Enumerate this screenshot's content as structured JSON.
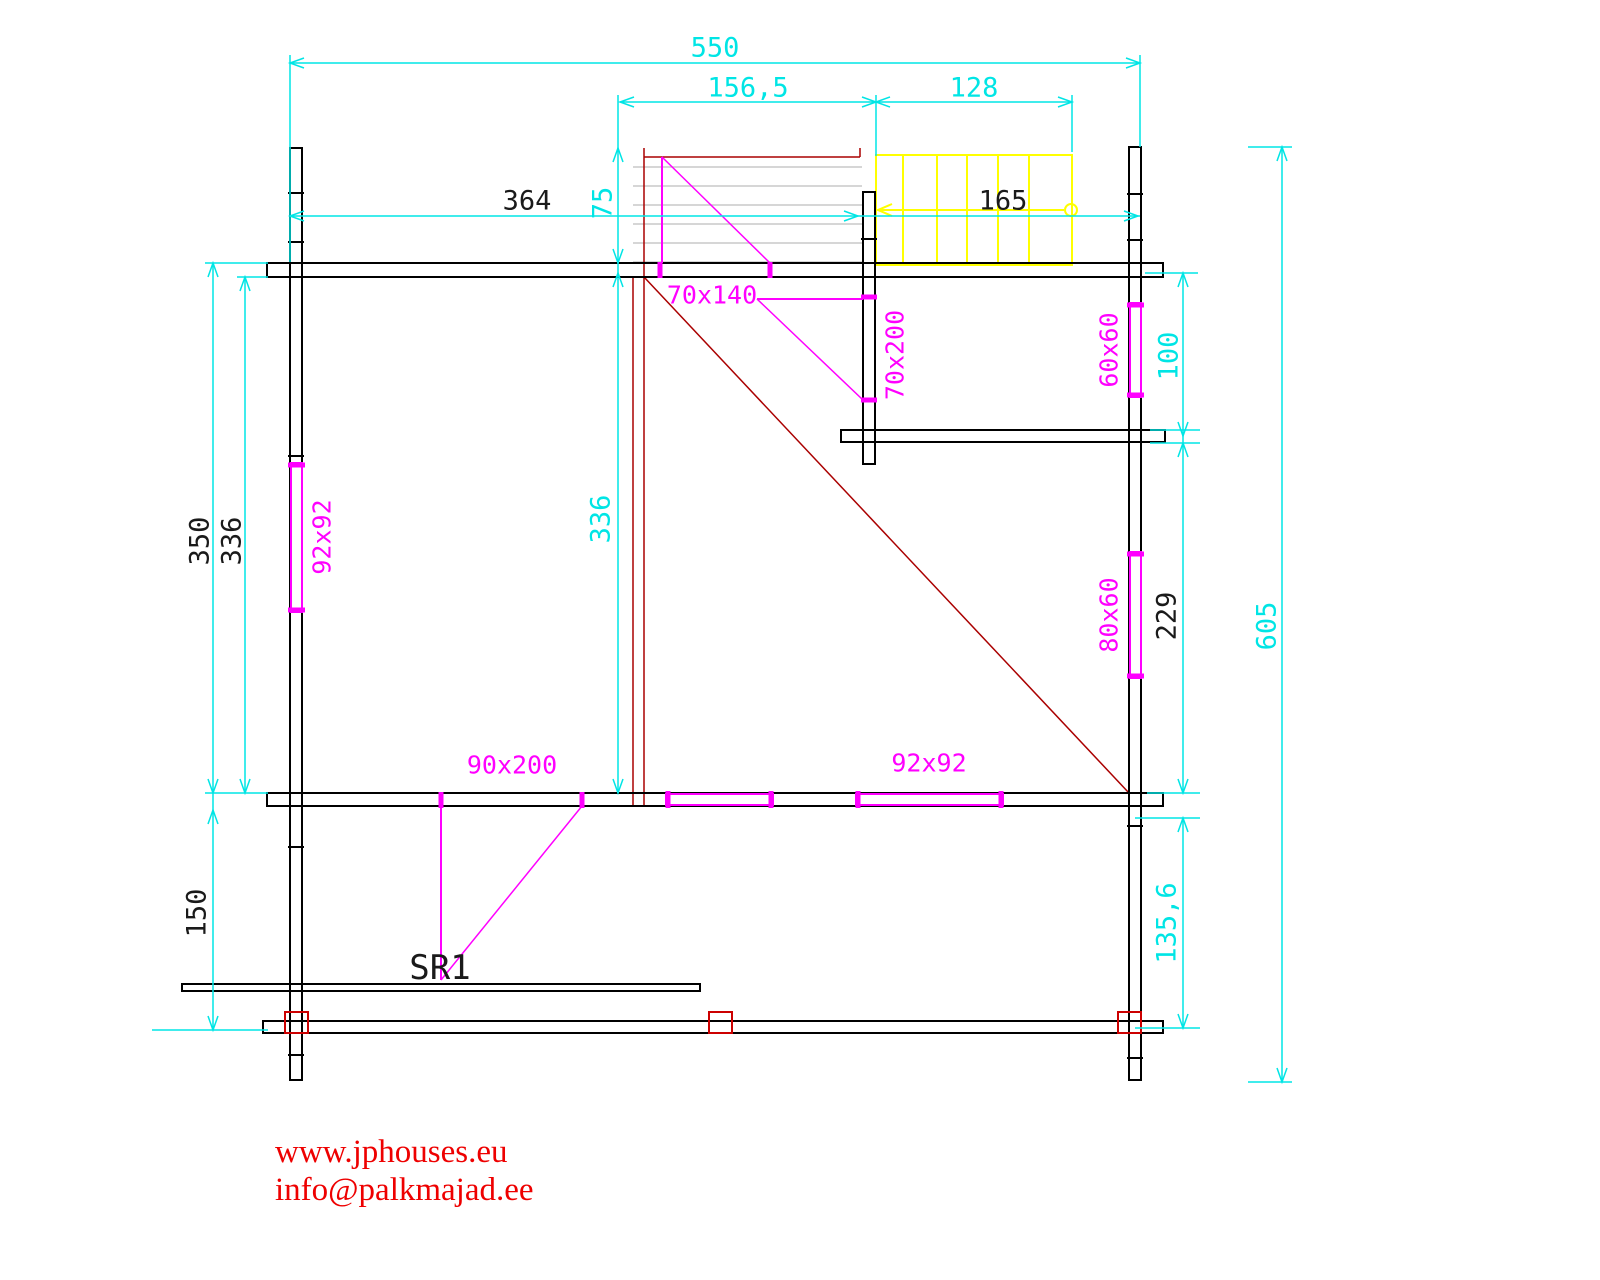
{
  "meta": {
    "type": "log-cabin floor plan drawing",
    "plan_name": "SR1"
  },
  "colors": {
    "dimension": "#00e5e5",
    "wall": "#000000",
    "opening": "#ff00ff",
    "stairs": "#ffff00",
    "construction": "#aa0000",
    "posts": "#cc0000",
    "loft_floor": "#c9c9c9",
    "footer": "#ee0000"
  },
  "dims": {
    "overall_width": "550",
    "landing_width": "156,5",
    "stair_width": "128",
    "wall_to_stair": "364",
    "landing_depth": "75",
    "stair_length": "165",
    "left_outer_depth": "350",
    "left_inner_depth": "336",
    "mid_inner_depth": "336",
    "right_upper": "100",
    "right_mid": "229",
    "right_lower": "135,6",
    "overall_depth": "605",
    "terrace_depth": "150"
  },
  "openings": {
    "loft_door": "70x140",
    "bath_door": "70x200",
    "left_window": "92x92",
    "right_window_upper": "60x60",
    "right_window_lower": "80x60",
    "main_door": "90x200",
    "bottom_window": "92x92"
  },
  "labels": {
    "plan_name": "SR1"
  },
  "footer": {
    "website": "www.jphouses.eu",
    "email": "info@palkmajad.ee"
  }
}
